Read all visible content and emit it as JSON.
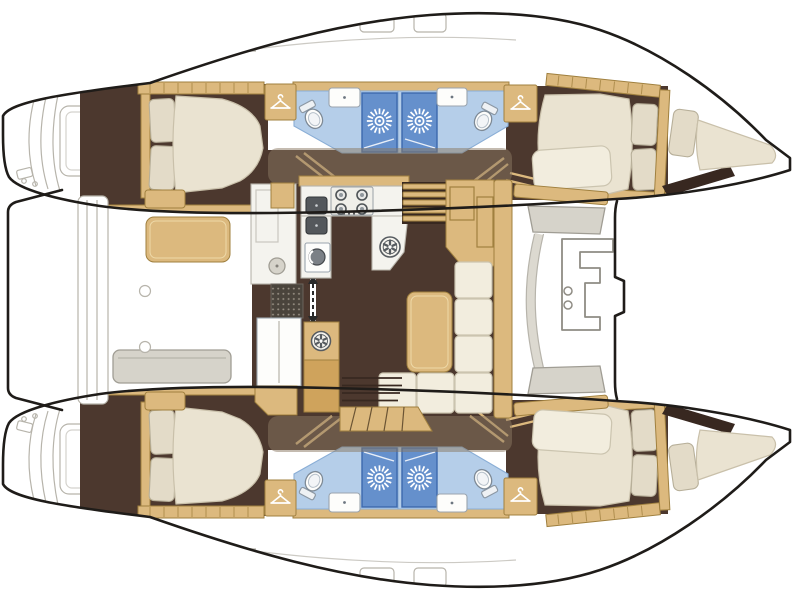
{
  "meta": {
    "title": "catamaran-interior-floor-plan",
    "view": "top-down",
    "bow_direction": "right",
    "visible_text": ""
  },
  "colors": {
    "outline": "#1f1c19",
    "hull-fill": "#ffffff",
    "deck-line": "#b7b4ab",
    "wood": "#dcb97e",
    "wood-dark": "#cfa35c",
    "wood-border": "#a0803f",
    "floor": "#4c382e",
    "floor-dark": "#382820",
    "mattress": "#eae3d1",
    "mattress-edge": "#c9c0aa",
    "pillow": "#e3dbc8",
    "pillow-edge": "#b7af99",
    "cushion": "#f2edde",
    "cushion-edge": "#cbc4af",
    "bath-floor": "#b5cee9",
    "bath-edge": "#8aaed6",
    "shower": "#6590cc",
    "shower-border": "#3c69ad",
    "counter": "#f4f3ee",
    "fixture-white": "#fdfdfb",
    "steel": "#54585c",
    "steel-dark": "#35383b",
    "steel-light": "#9aa4ae",
    "gray-seat": "#d6d3ca",
    "gray-border": "#a09d94",
    "olive": "#8a7761",
    "mat-dark": "#4a443c",
    "mat-dot": "#968e82"
  },
  "icons": [
    {
      "name": "sunburst-shower-icon",
      "count": 4,
      "meaning": "shower stall"
    },
    {
      "name": "hanger-wardrobe-icon",
      "count": 4,
      "meaning": "wardrobe / hanging locker"
    },
    {
      "name": "spoked-hatch-icon",
      "count": 2,
      "meaning": "round hatch"
    },
    {
      "name": "double-arrow-door-icon",
      "count": 1,
      "meaning": "sliding door passage"
    },
    {
      "name": "stove-burner-icon",
      "count": 4,
      "meaning": "galley cooktop burners"
    }
  ],
  "layout": {
    "hulls": [
      {
        "id": "port-hull",
        "position": "top",
        "spaces": [
          {
            "id": "port-aft-cabin",
            "fixtures": [
              "double-bed",
              "pillows",
              "shelf",
              "step"
            ]
          },
          {
            "id": "port-aft-bathroom",
            "fixtures": [
              "toilet",
              "sink",
              "shower"
            ]
          },
          {
            "id": "port-forward-bathroom",
            "fixtures": [
              "shower",
              "sink",
              "toilet"
            ]
          },
          {
            "id": "port-forward-cabin",
            "fixtures": [
              "double-bed",
              "pillows",
              "wardrobe",
              "bow-berth"
            ]
          }
        ]
      },
      {
        "id": "starboard-hull",
        "position": "bottom",
        "spaces": [
          {
            "id": "starboard-aft-cabin",
            "fixtures": [
              "double-bed",
              "pillows",
              "shelf",
              "step"
            ]
          },
          {
            "id": "starboard-aft-bathroom",
            "fixtures": [
              "toilet",
              "sink",
              "shower"
            ]
          },
          {
            "id": "starboard-forward-bathroom",
            "fixtures": [
              "shower",
              "sink",
              "toilet"
            ]
          },
          {
            "id": "starboard-forward-cabin",
            "fixtures": [
              "double-bed",
              "pillows",
              "wardrobe",
              "bow-berth"
            ]
          }
        ]
      }
    ],
    "salon": {
      "id": "salon",
      "fixtures": [
        "u-shaped-galley",
        "cooktop-4-burners",
        "double-sink",
        "fridge",
        "round-hatch",
        "entry-mat",
        "sliding-door",
        "chart-table",
        "l-shaped-sofa",
        "dining-table",
        "companionway-steps-port",
        "companionway-steps-starboard"
      ]
    },
    "aft-cockpit": {
      "id": "aft-cockpit",
      "fixtures": [
        "cockpit-table",
        "bench-seat",
        "transom-steps-port",
        "transom-steps-starboard",
        "aft-platform"
      ]
    },
    "foredeck": {
      "id": "foredeck",
      "fixtures": [
        "forward-bench",
        "cup-holders",
        "seat-cushions",
        "bow-platform-edge"
      ]
    },
    "counts": {
      "cabins": 4,
      "bathrooms": 4,
      "showers": 4,
      "toilets": 4,
      "sinks": 6,
      "wardrobes": 4
    }
  }
}
